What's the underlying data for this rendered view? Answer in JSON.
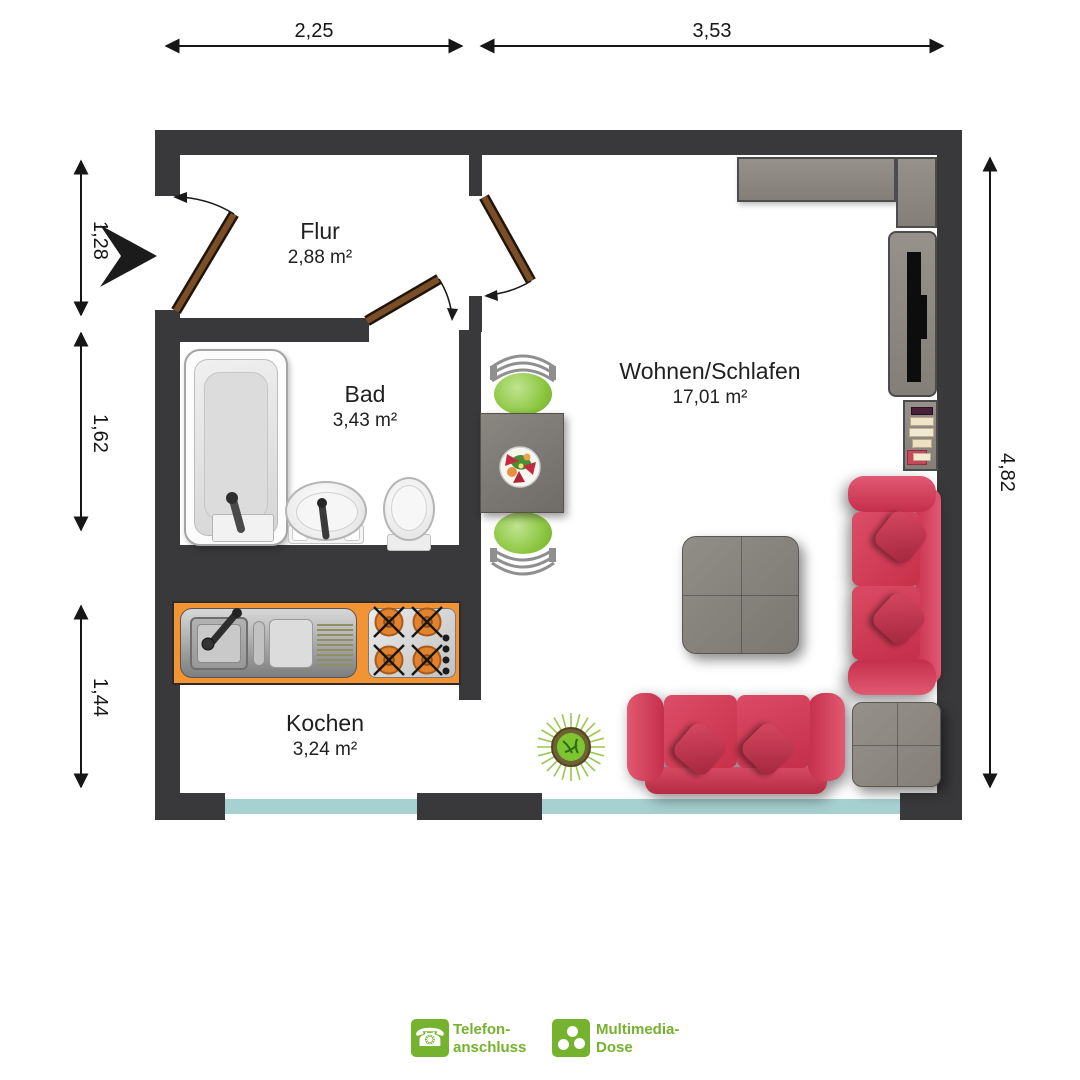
{
  "plan": {
    "rooms": [
      {
        "id": "flur",
        "name": "Flur",
        "area": "2,88 m²"
      },
      {
        "id": "bad",
        "name": "Bad",
        "area": "3,43 m²"
      },
      {
        "id": "wohnen",
        "name": "Wohnen/Schlafen",
        "area": "17,01 m²"
      },
      {
        "id": "kochen",
        "name": "Kochen",
        "area": "3,24 m²"
      }
    ],
    "dimensions": {
      "top": [
        "2,25",
        "3,53"
      ],
      "left": [
        "1,28",
        "1,62",
        "1,44"
      ],
      "right": [
        "4,82"
      ]
    }
  },
  "legend": {
    "items": [
      {
        "icon": "telephone-icon",
        "lines": [
          "Telefon-",
          "anschluss"
        ]
      },
      {
        "icon": "multimedia-socket-icon",
        "lines": [
          "Multimedia-",
          "Dose"
        ]
      }
    ]
  },
  "colors": {
    "wall": "#39393b",
    "window_glass": "#a7d0d1",
    "door_wood": "#7a4f28",
    "sofa_red": "#d23c55",
    "kitchen_orange": "#f39434",
    "furniture_gray": "#8f8a85",
    "chair_green": "#8cc640",
    "legend_green": "#75b22d",
    "text": "#1f1f1f"
  }
}
